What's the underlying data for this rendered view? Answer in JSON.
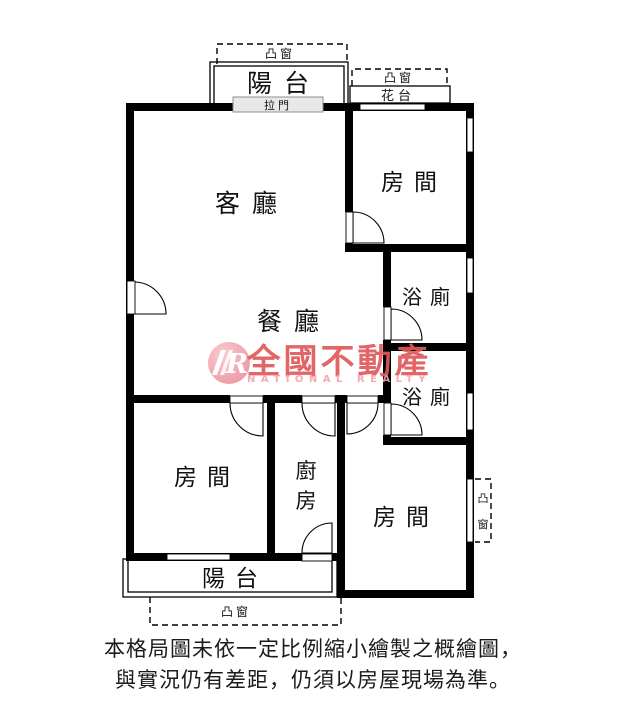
{
  "plan": {
    "labels": {
      "living_room": "客廳",
      "dining_room": "餐廳",
      "room_top_right": "房間",
      "room_bottom_left": "房間",
      "room_bottom_right": "房間",
      "bathroom_upper": "浴廁",
      "bathroom_lower": "浴廁",
      "kitchen_chars": [
        "廚",
        "房"
      ],
      "balcony_top": "陽台",
      "balcony_bottom": "陽台",
      "flower_bed": "花台",
      "sliding_door": "拉門",
      "bay_window_top_left": "凸窗",
      "bay_window_top_right": "凸窗",
      "bay_window_bottom": "凸窗",
      "bay_window_right_chars": [
        "凸",
        "窗"
      ]
    },
    "colors": {
      "wall": "#000000",
      "sliding_door_fill": "#e8e8e8",
      "sliding_door_border": "#8f8f8f"
    }
  },
  "watermark": {
    "logo_letter": "R",
    "brand_zh": "全國不動產",
    "brand_en": "NATIONAL REALTY",
    "colors": {
      "brand_red": "#e0595c",
      "logo_pink_outer": "#ec8f9b",
      "logo_pink_inner": "#f8c6cc",
      "en_pink": "#f2a4ac"
    }
  },
  "disclaimer": {
    "line1": "本格局圖未依一定比例縮小繪製之概繪圖，",
    "line2": "與實況仍有差距，仍須以房屋現場為準。"
  }
}
